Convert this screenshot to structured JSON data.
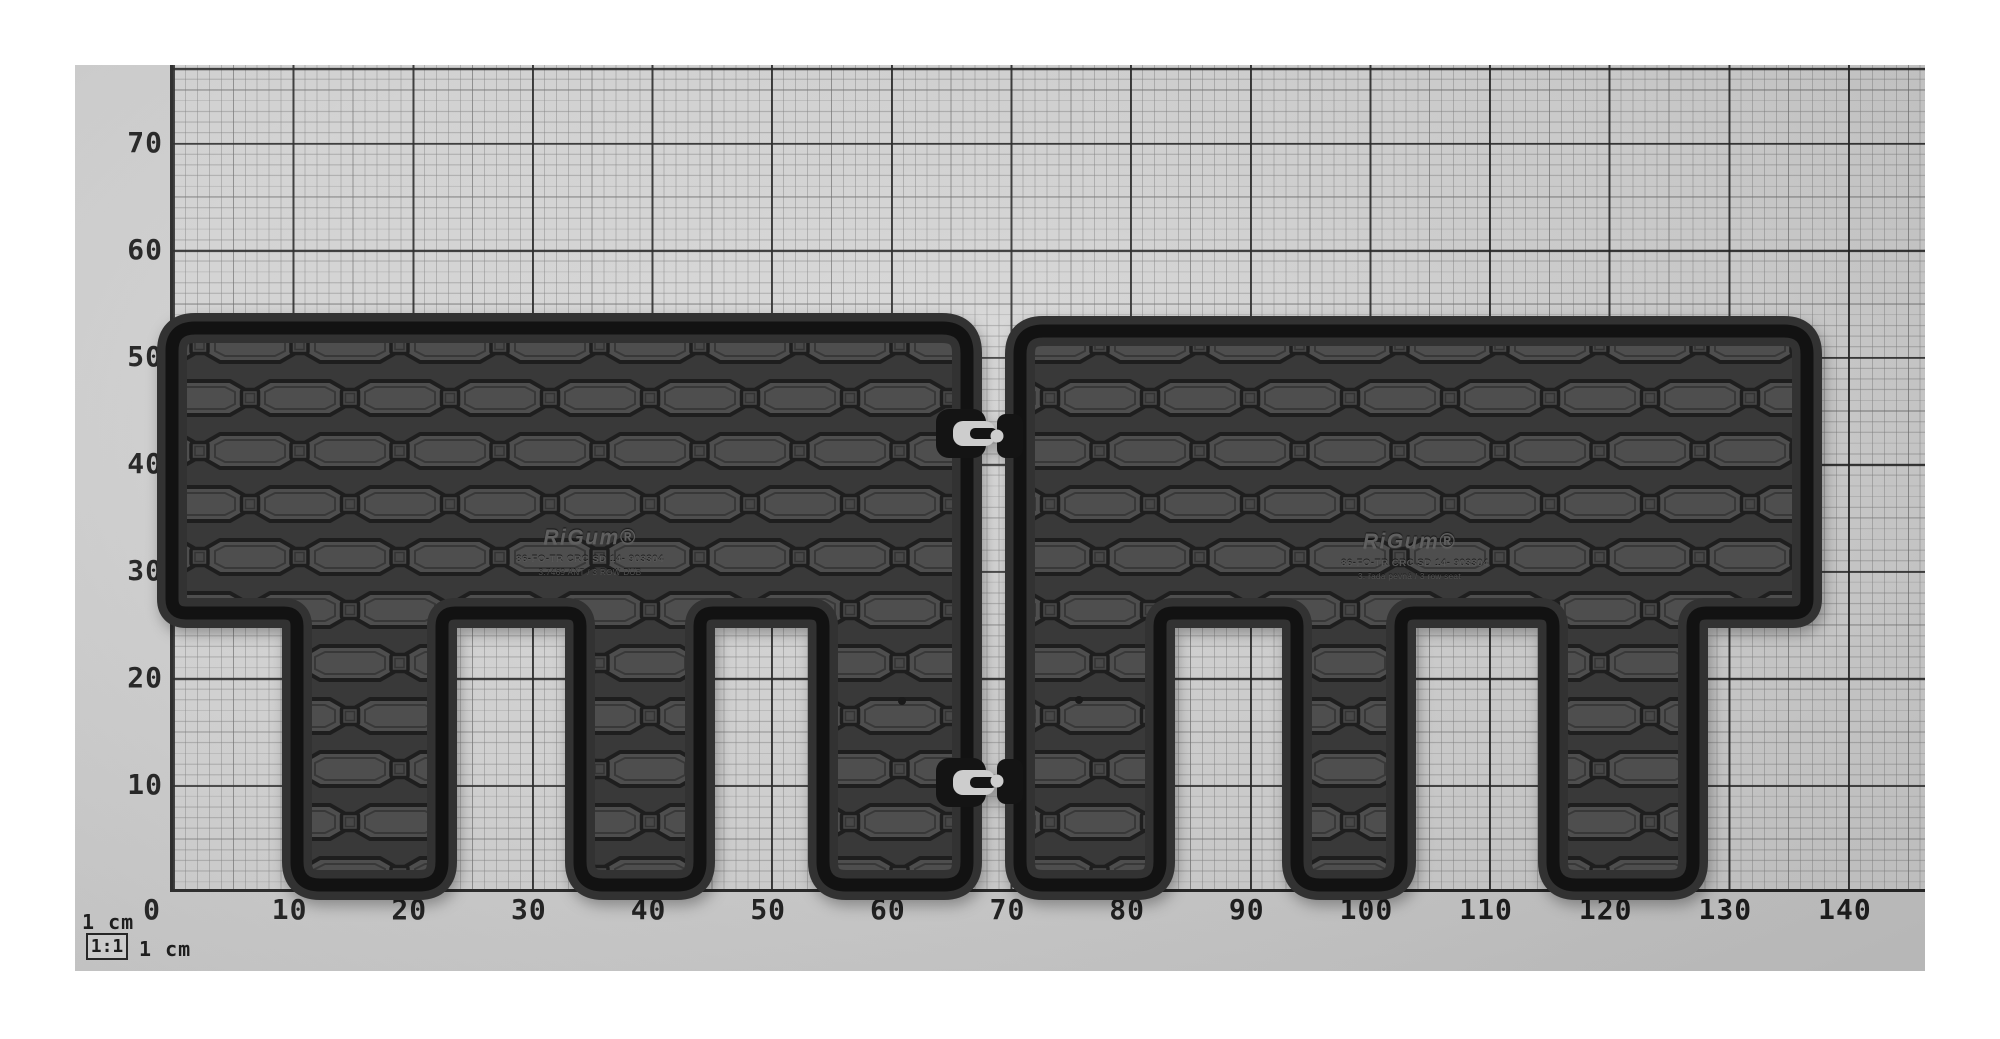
{
  "title": "Two rubber boot/row mats on 1 cm measuring grid",
  "legend": {
    "top": "1 cm",
    "scale": "1:1",
    "unit": "1 cm"
  },
  "axes": {
    "x_labels": [
      "0",
      "10",
      "20",
      "30",
      "40",
      "50",
      "60",
      "70",
      "80",
      "90",
      "100",
      "110",
      "120",
      "130",
      "140"
    ],
    "y_labels": [
      "70",
      "60",
      "50",
      "40",
      "30",
      "20",
      "10"
    ]
  },
  "mats": {
    "left": {
      "logo": "RiGum®",
      "code": "86-FO-TR CRC SD 14- 903304",
      "note": "3.7469 ANT / 3 ROW DUB"
    },
    "right": {
      "logo": "RiGum®",
      "code": "86-FO-TR CRC SD 14- 903304",
      "note": "3. řada pevná / 3 row seat"
    }
  },
  "colors": {
    "background": "#ffffff",
    "paper": "#cfcfcf",
    "grid_major": "#2b2b2b",
    "grid_fine": "#a8a8a8",
    "mat_base": "#393939",
    "mat_hex": "#4e4e4e",
    "mat_rim": "#121212"
  }
}
